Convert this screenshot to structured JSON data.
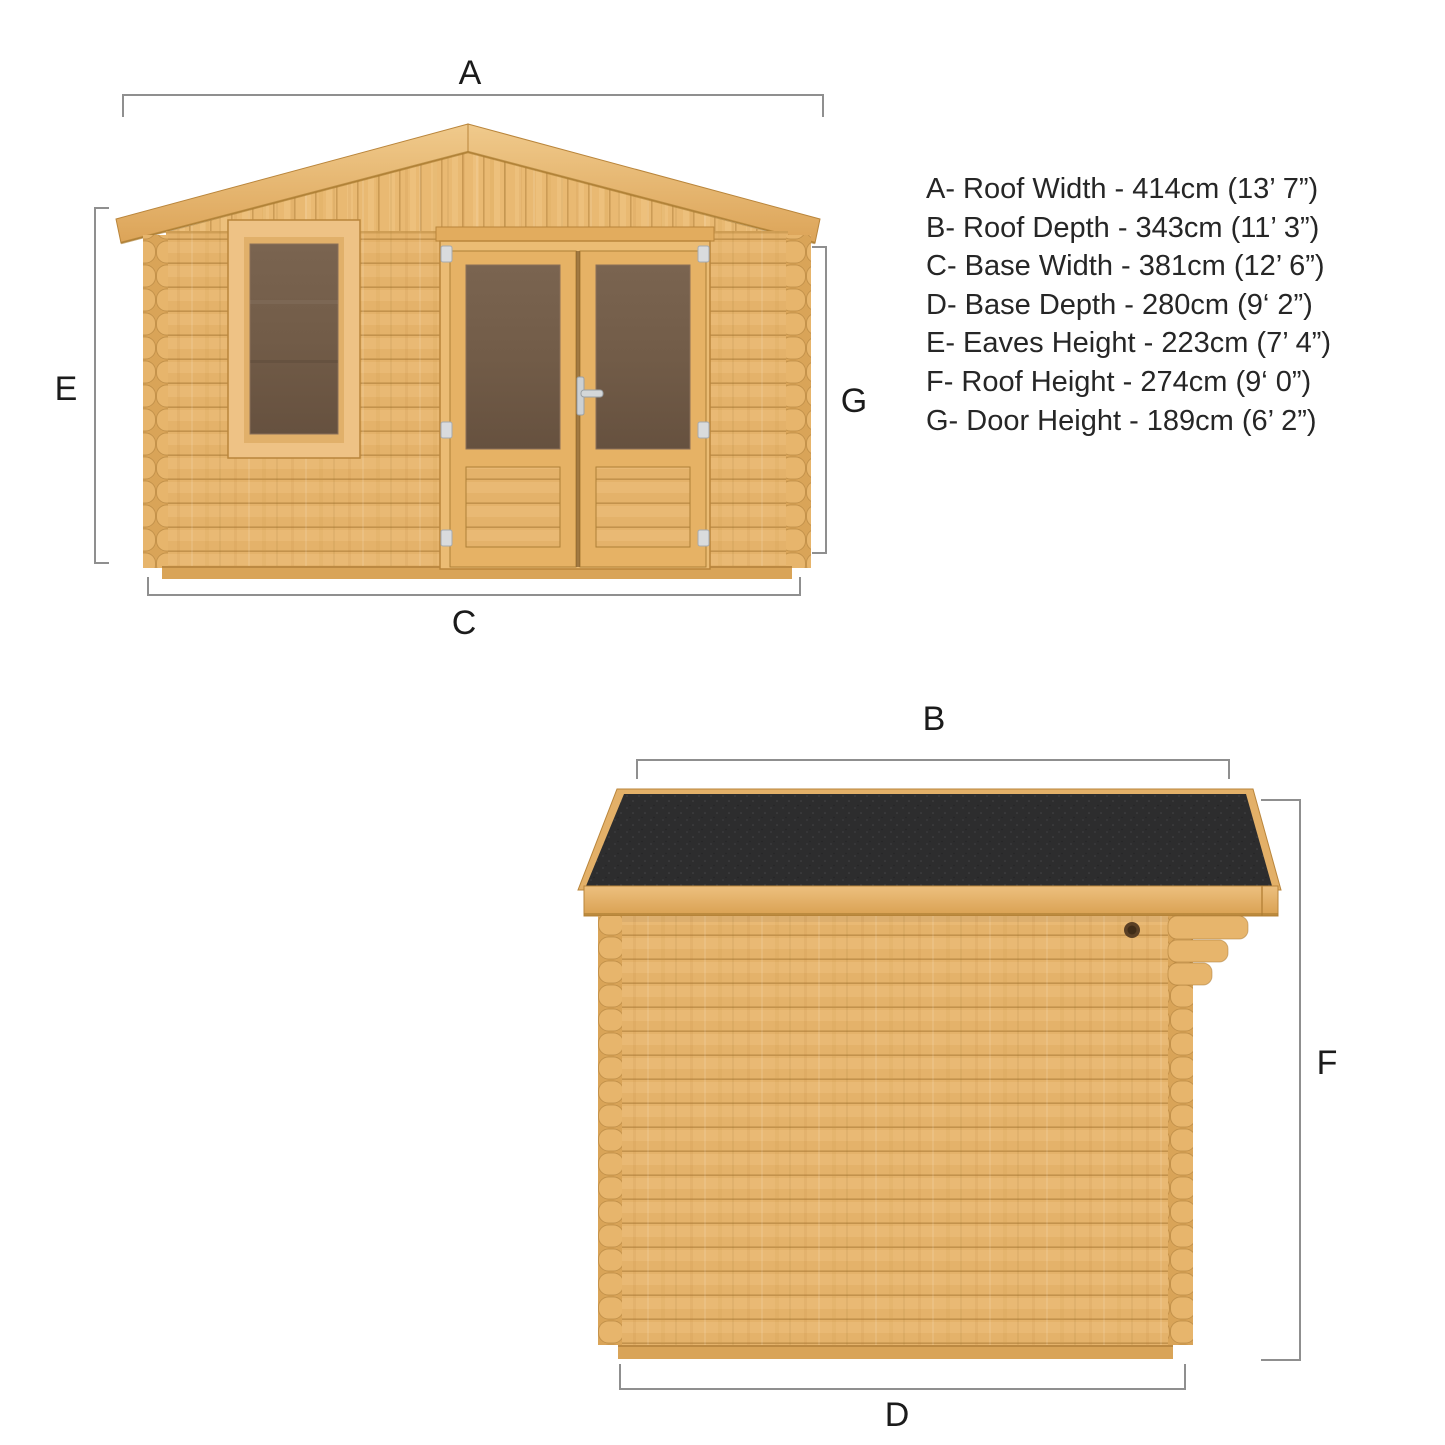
{
  "figure": {
    "kind": "log-cabin dimension diagram",
    "views": [
      "front elevation",
      "side elevation"
    ]
  },
  "front_view": {
    "labels": {
      "roof_width": "A",
      "base_width": "C",
      "eaves_height": "E",
      "door_height": "G"
    }
  },
  "side_view": {
    "labels": {
      "roof_depth": "B",
      "base_depth": "D",
      "roof_height": "F"
    }
  },
  "specs": [
    "A- Roof Width - 414cm (13’ 7”)",
    "B- Roof Depth - 343cm (11’ 3”)",
    "C- Base Width - 381cm (12’ 6”)",
    "D- Base Depth - 280cm (9‘ 2”)",
    "E- Eaves Height - 223cm (7’ 4”)",
    "F- Roof Height - 274cm (9‘ 0”)",
    "G- Door Height - 189cm (6’ 2”)"
  ],
  "measurements": [
    {
      "key": "A",
      "label": "Roof Width",
      "cm": 414,
      "imperial": "13’ 7”"
    },
    {
      "key": "B",
      "label": "Roof Depth",
      "cm": 343,
      "imperial": "11’ 3”"
    },
    {
      "key": "C",
      "label": "Base Width",
      "cm": 381,
      "imperial": "12’ 6”"
    },
    {
      "key": "D",
      "label": "Base Depth",
      "cm": 280,
      "imperial": "9’ 2”"
    },
    {
      "key": "E",
      "label": "Eaves Height",
      "cm": 223,
      "imperial": "7’ 4”"
    },
    {
      "key": "F",
      "label": "Roof Height",
      "cm": 274,
      "imperial": "9’ 0”"
    },
    {
      "key": "G",
      "label": "Door Height",
      "cm": 189,
      "imperial": "6’ 2”"
    }
  ],
  "colors": {
    "wood_base": "#E4B26A",
    "wood_light": "#F0C98B",
    "wood_dark": "#D9A051",
    "wood_line": "#A87833",
    "roof_felt": "#2D2D2E",
    "glass_top": "#7A6450",
    "glass_bottom": "#66513F",
    "fittings_silver": "#D6D8DA",
    "dimension_line": "#8F8F8F",
    "text": "#262626"
  }
}
